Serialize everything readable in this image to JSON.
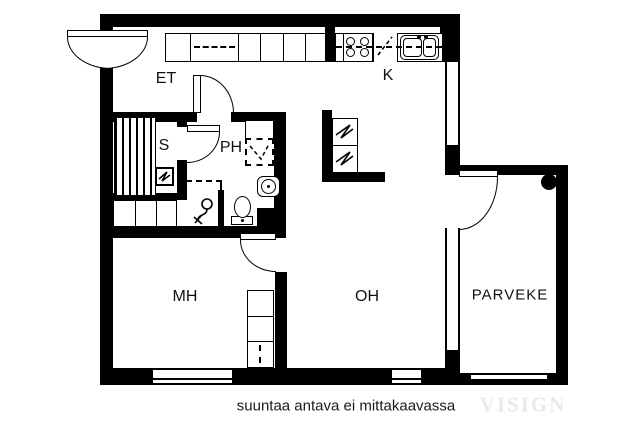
{
  "rooms": {
    "et": "ET",
    "k": "K",
    "s": "S",
    "ph": "PH",
    "mh": "MH",
    "oh": "OH",
    "parveke": "PARVEKE"
  },
  "footer": {
    "caption": "suuntaa antava ei mittakaavassa",
    "watermark": "VISIGN"
  },
  "colors": {
    "wall": "#000000",
    "background": "#ffffff",
    "caption_text": "#1a1a1a",
    "watermark_text": "#ece9e4"
  }
}
